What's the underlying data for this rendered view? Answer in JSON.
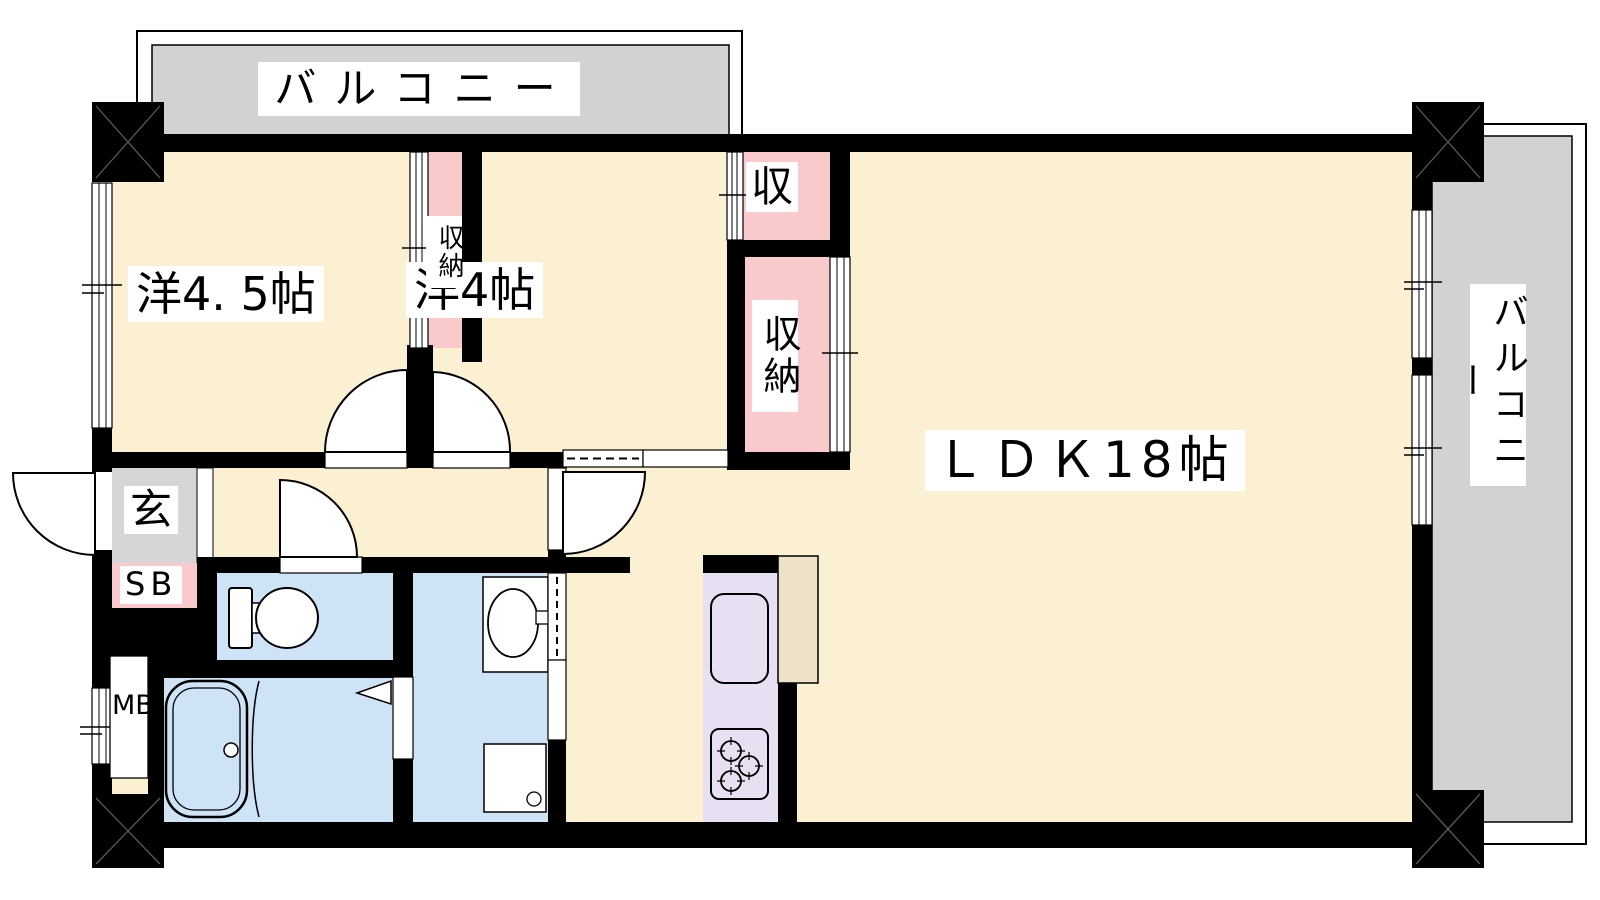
{
  "plan": {
    "type": "apartment-floorplan",
    "labels": {
      "balcony_top": "バルコニー",
      "balcony_right": "バルコニー",
      "room_45": "洋4. 5帖",
      "room_4": "洋4帖",
      "closet_center": "収納",
      "closet_top_right": "収",
      "closet_right": "収納",
      "ldk": "ＬＤＫ18帖",
      "entrance": "玄",
      "shoe_box": "SB",
      "meter_box": "MB"
    },
    "rooms": [
      {
        "name": "洋4. 5帖",
        "type": "western-room"
      },
      {
        "name": "洋4帖",
        "type": "western-room"
      },
      {
        "name": "ＬＤＫ18帖",
        "type": "living-dining-kitchen"
      },
      {
        "name": "バルコニー",
        "type": "balcony-north"
      },
      {
        "name": "バルコニー",
        "type": "balcony-east"
      },
      {
        "name": "収納",
        "type": "closet"
      },
      {
        "name": "収",
        "type": "closet"
      },
      {
        "name": "玄",
        "type": "entrance"
      },
      {
        "name": "SB",
        "type": "shoe-box"
      },
      {
        "name": "MB",
        "type": "meter-box"
      }
    ],
    "colors": {
      "floor": "#FCF0D3",
      "balcony": "#D2D2D2",
      "entrance_tile": "#D6D6D6",
      "closet": "#F9C9CB",
      "wet_area": "#CFE3F6",
      "kitchen_counter": "#E8E0F2",
      "counter_side": "#EDE1C9",
      "wall": "#000000"
    }
  }
}
